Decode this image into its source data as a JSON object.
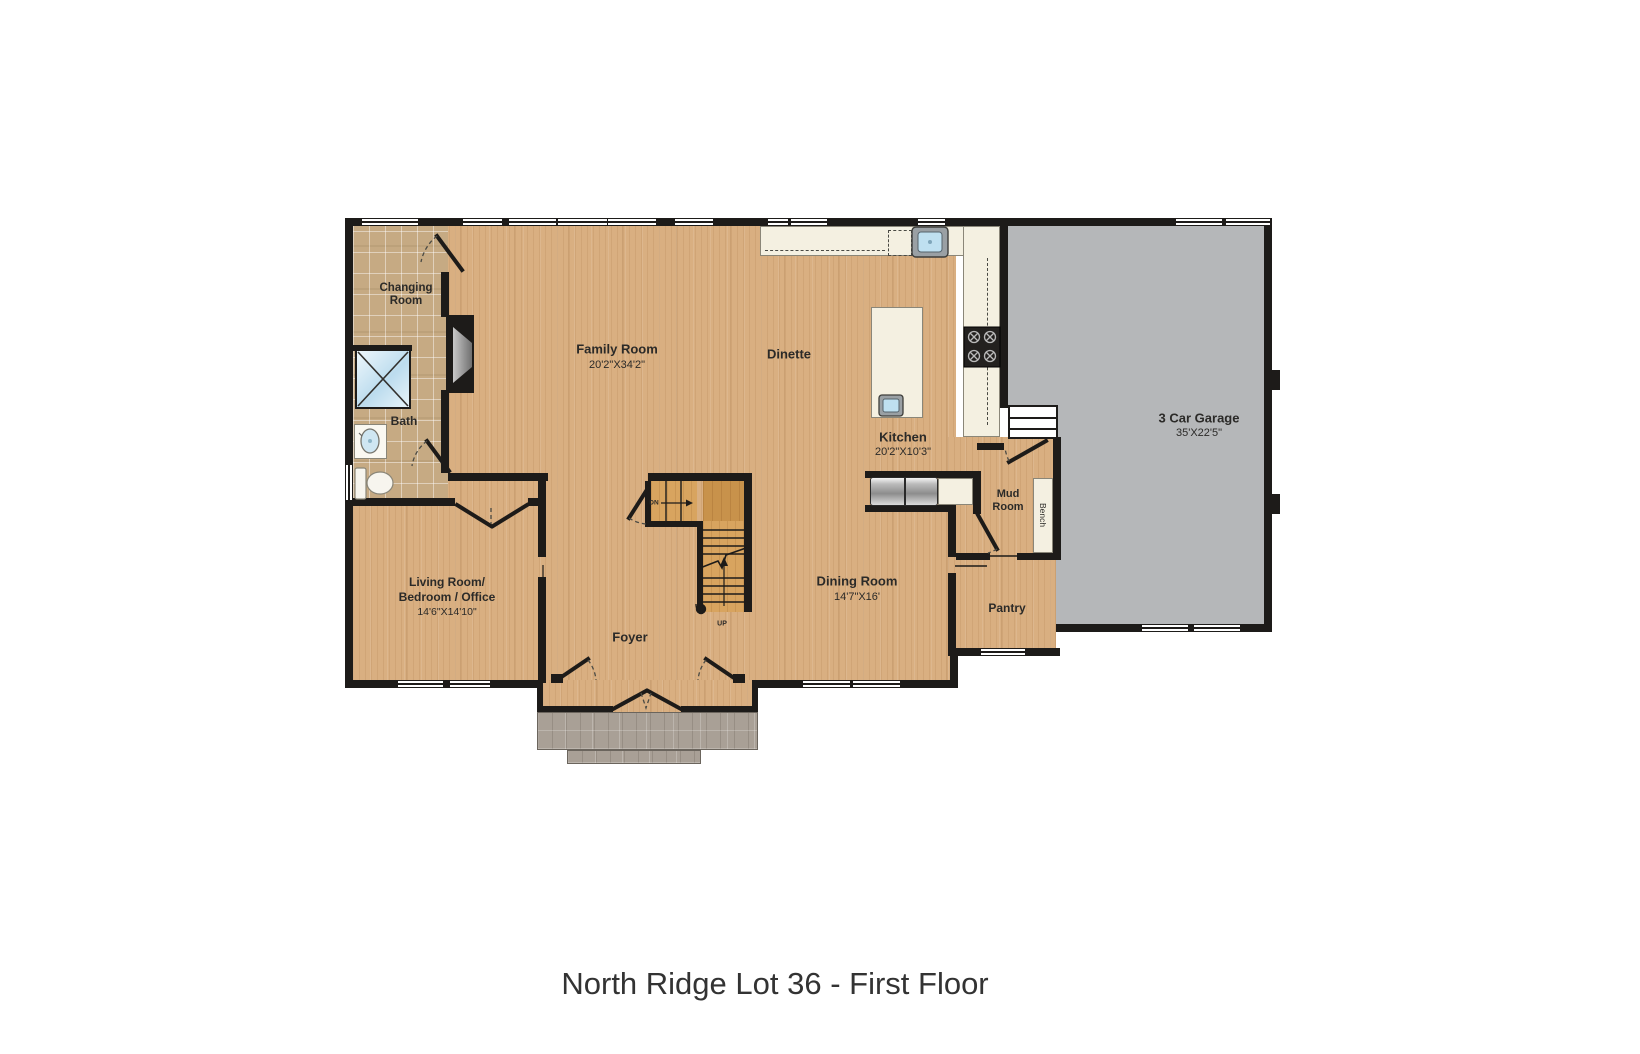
{
  "title": "North Ridge Lot 36 - First Floor",
  "rooms": {
    "changing_room": {
      "line1": "Changing",
      "line2": "Room"
    },
    "bath": {
      "name": "Bath"
    },
    "family_room": {
      "name": "Family Room",
      "dims": "20'2\"X34'2\""
    },
    "dinette": {
      "name": "Dinette"
    },
    "kitchen": {
      "name": "Kitchen",
      "dims": "20'2\"X10'3\""
    },
    "garage": {
      "name": "3 Car Garage",
      "dims": "35'X22'5\""
    },
    "mud_room": {
      "line1": "Mud",
      "line2": "Room"
    },
    "bench": {
      "name": "Bench"
    },
    "pantry": {
      "name": "Pantry"
    },
    "dining_room": {
      "name": "Dining Room",
      "dims": "14'7\"X16'"
    },
    "living_room": {
      "line1": "Living Room/",
      "line2": "Bedroom / Office",
      "dims": "14'6\"X14'10\""
    },
    "foyer": {
      "name": "Foyer"
    },
    "stairs": {
      "up": "UP",
      "down": "DN"
    }
  },
  "colors": {
    "wood": "#d9af81",
    "tile": "#c6aa83",
    "garage": "#b5b7b9",
    "wall": "#1d1b19",
    "counter": "#f4f0e1",
    "porch": "#a9a096"
  }
}
